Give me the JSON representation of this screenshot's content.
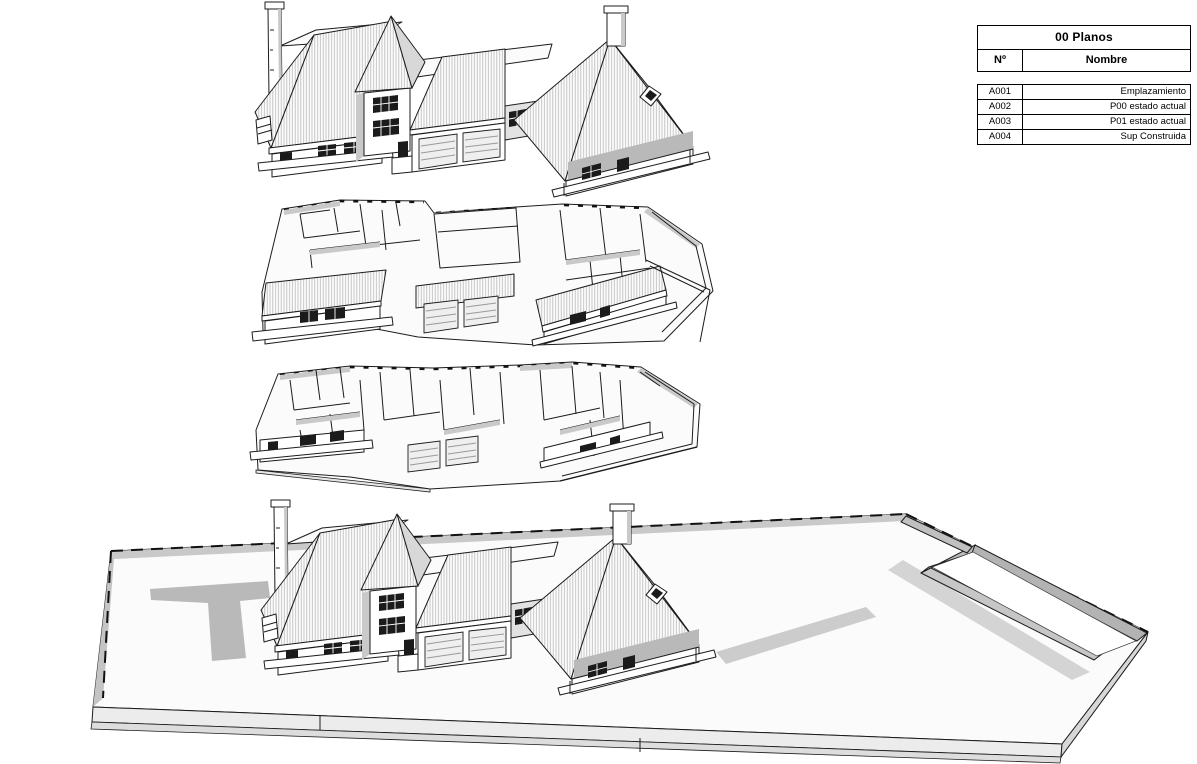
{
  "sheet_list": {
    "title": "00 Planos",
    "columns": {
      "number": "Nº",
      "name": "Nombre"
    },
    "rows": [
      {
        "number": "A001",
        "name": "Emplazamiento"
      },
      {
        "number": "A002",
        "name": "P00 estado actual"
      },
      {
        "number": "A003",
        "name": "P01 estado actual"
      },
      {
        "number": "A004",
        "name": "Sup Construida"
      }
    ]
  },
  "colors": {
    "paper": "#ffffff",
    "line": "#1c1c1c",
    "roof_hatch": "#b9b9b9",
    "wall_shade": "#c9c9c9",
    "ground_shadow": "#bdbdbd"
  }
}
